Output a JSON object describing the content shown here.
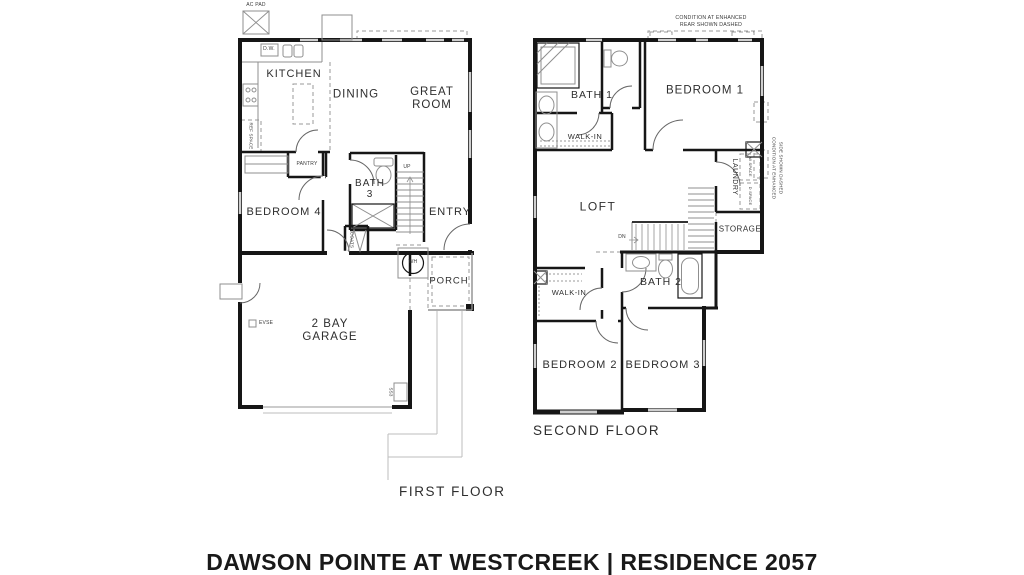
{
  "title": "DAWSON POINTE AT WESTCREEK | RESIDENCE 2057",
  "colors": {
    "wall": "#161616",
    "fixture": "#8f8f8f",
    "window": "#cfcfcf",
    "text": "#2e2e2e"
  },
  "first_floor": {
    "caption": "FIRST FLOOR",
    "rooms": {
      "kitchen": "KITCHEN",
      "dining": "DINING",
      "great_room": "GREAT ROOM",
      "bedroom_4": "BEDROOM 4",
      "bath_3": "BATH 3",
      "entry": "ENTRY",
      "porch": "PORCH",
      "garage": "2 BAY GARAGE"
    },
    "annotations": {
      "ac_pad": "AC PAD",
      "dishwasher": "D.W.",
      "ref_space": "REF SPACE",
      "pantry": "PANTRY",
      "stairs_up": "UP",
      "coats": "COATS",
      "water_heater": "WH",
      "evse": "EVSE",
      "ss3": "SS3"
    }
  },
  "second_floor": {
    "caption": "SECOND FLOOR",
    "rooms": {
      "bath_1": "BATH 1",
      "bedroom_1": "BEDROOM 1",
      "walk_in_top": "WALK-IN",
      "loft": "LOFT",
      "laundry": "LAUNDRY",
      "storage": "STORAGE",
      "bath_2": "BATH 2",
      "walk_in_bottom": "WALK-IN",
      "bedroom_2": "BEDROOM 2",
      "bedroom_3": "BEDROOM 3"
    },
    "annotations": {
      "stairs_dn": "DN",
      "washer_space": "W SPACE",
      "dryer_space": "D SPACE",
      "note_rear_line_1": "CONDITION AT ENHANCED",
      "note_rear_line_2": "REAR SHOWN DASHED",
      "note_side_line_1": "CONDITION AT ENHANCED",
      "note_side_line_2": "SIDE SHOWN DASHED"
    }
  }
}
